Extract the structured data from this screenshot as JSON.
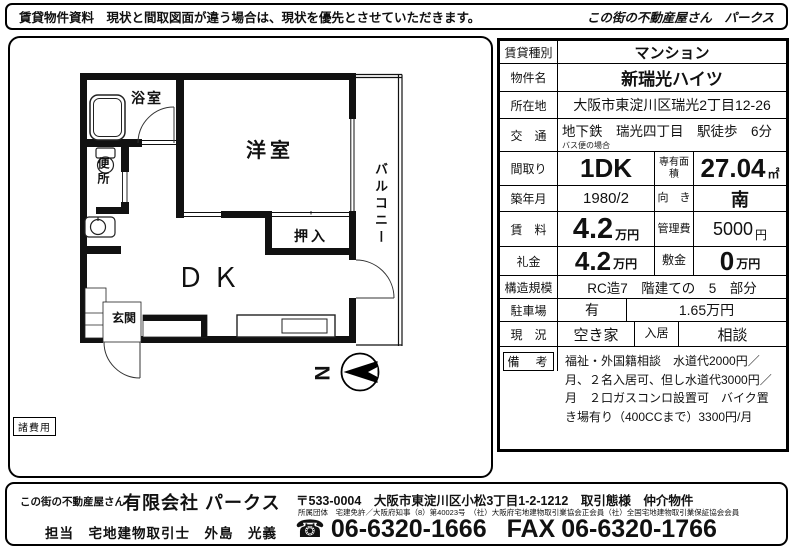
{
  "header": {
    "notice": "賃貸物件資料　現状と間取図面が違う場合は、現状を優先とさせていただきます。",
    "brand": "この街の不動産屋さん　パークス"
  },
  "floorplan": {
    "rooms": {
      "western_room": "洋室",
      "dk": "ＤＫ",
      "bath": "浴室",
      "toilet": "便所",
      "closet": "押入",
      "balcony": "バルコニー",
      "entrance": "玄関"
    },
    "cost_note": "諸費用",
    "compass_north": "N"
  },
  "table": {
    "type": {
      "label": "賃貸種別",
      "value": "マンション"
    },
    "name": {
      "label": "物件名",
      "value": "新瑞光ハイツ"
    },
    "address": {
      "label": "所在地",
      "value": "大阪市東淀川区瑞光2丁目12-26"
    },
    "access": {
      "label": "交　通",
      "value": "地下鉄　瑞光四丁目　駅徒歩　6分",
      "note": "バス便の場合"
    },
    "layout": {
      "label": "間取り",
      "value": "1DK",
      "label2": "専有面積",
      "value2": "27.04",
      "unit2": "㎡"
    },
    "built": {
      "label": "築年月",
      "value": "1980/2",
      "label2": "向　き",
      "value2": "南"
    },
    "rent": {
      "label": "賃　料",
      "value": "4.2",
      "unit": "万円",
      "label2": "管理費",
      "value2": "5000",
      "unit2": "円"
    },
    "key_money": {
      "label": "礼金",
      "value": "4.2",
      "unit": "万円",
      "label2": "敷金",
      "value2": "0",
      "unit2": "万円"
    },
    "structure": {
      "label": "構造規模",
      "value": "RC造7　階建ての　5　部分"
    },
    "parking": {
      "label": "駐車場",
      "value": "有",
      "value2": "1.65万円"
    },
    "status": {
      "label": "現　況",
      "value": "空き家",
      "label2": "入居",
      "value2": "相談"
    },
    "remarks": {
      "label": "備　考",
      "value": "福祉・外国籍相談　水道代2000円／月、２名入居可、但し水道代3000円／月　２口ガスコンロ設置可　バイク置き場有り（400CCまで）3300円/月"
    }
  },
  "footer": {
    "brand_small": "この街の不動産屋さん",
    "brand": "有限会社 パークス",
    "postal": "〒533-0004　大阪市東淀川区小松3丁目1-2-1212　取引態様　仲介物件",
    "associations": "所属団体　宅建免許／大阪府知事（8）第40023号　（社）大阪府宅地建物取引業協会正会員（社）全国宅地建物取引業保証協会会員",
    "staff": "担当　宅地建物取引士　外島　光義",
    "phone_icon": "☎",
    "phone": "06-6320-1666",
    "fax_label": "FAX",
    "fax": "06-6320-1766"
  }
}
